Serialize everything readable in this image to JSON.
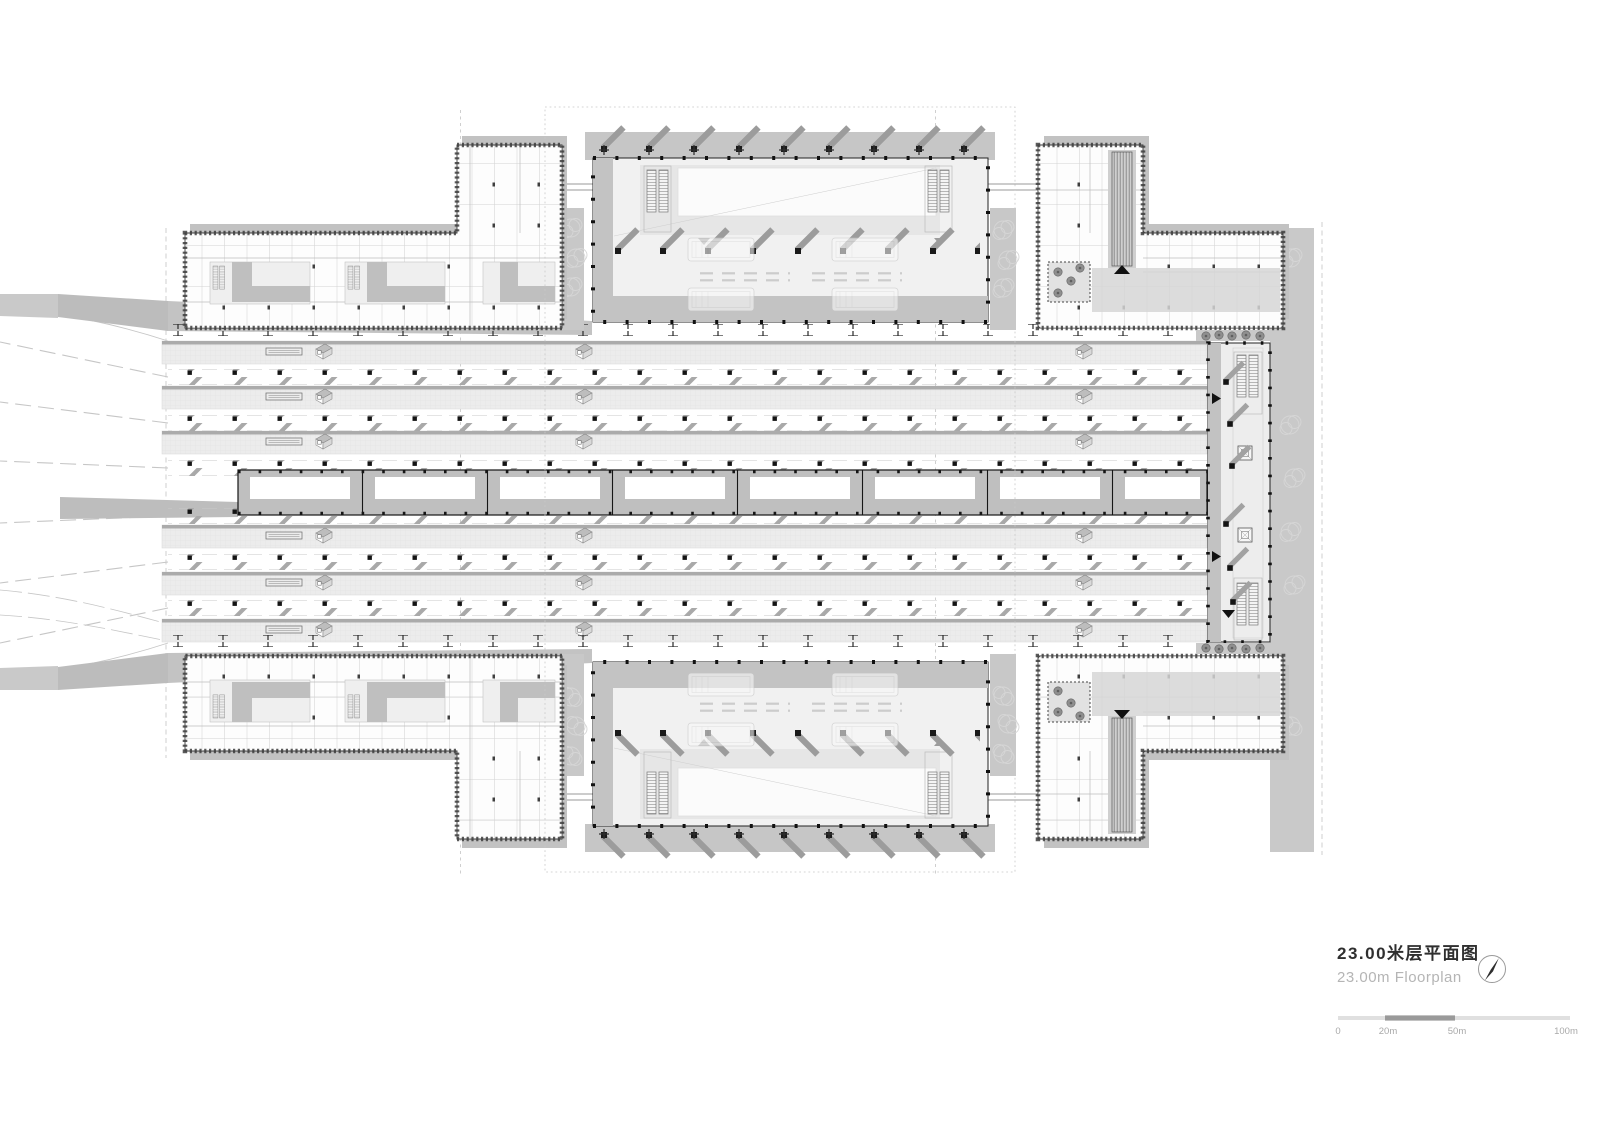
{
  "title_block": {
    "title_cn": "23.00米层平面图",
    "title_en": "23.00m Floorplan"
  },
  "north_arrow": {
    "icon": "north-arrow-icon"
  },
  "scale_bar": {
    "labels": [
      "0",
      "20m",
      "50m",
      "100m"
    ]
  },
  "palette": {
    "background": "#ffffff",
    "platform_fill": "#ececec",
    "apron_gray": "#c6c6c6",
    "shadow_gray": "#c2c2c2",
    "wall_dark": "#2b2b2b",
    "tick_gray": "#a2a2a2",
    "title_cn_color": "#2f2f2f",
    "title_en_color": "#b5b5b5",
    "scale_dark_segment": "#9a9a9a",
    "scale_light_segment": "#e0e0e0"
  }
}
